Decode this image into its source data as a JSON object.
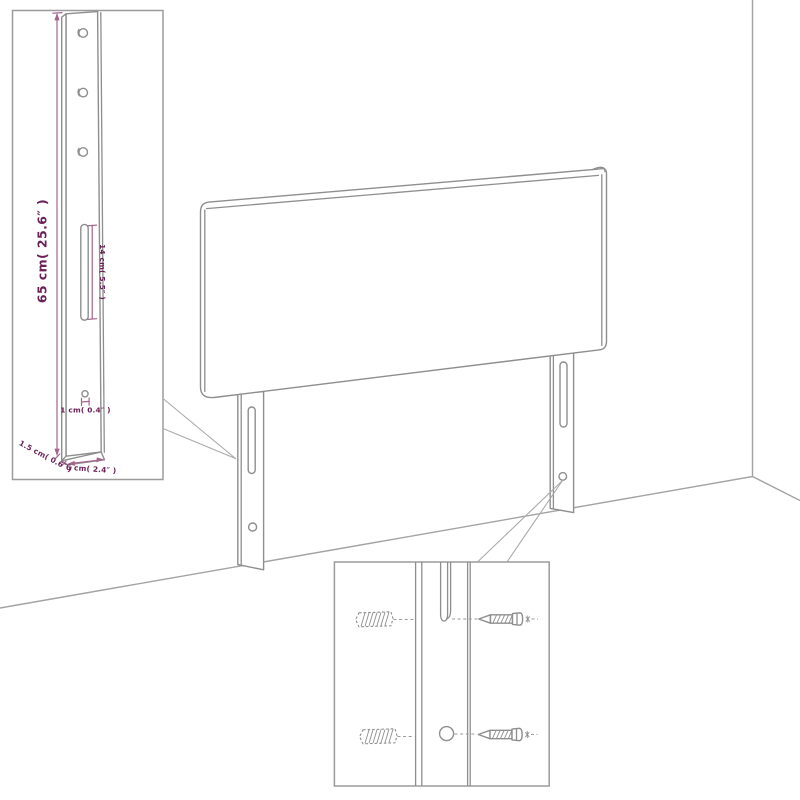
{
  "diagram": {
    "subject": "headboard-assembly-diagram",
    "colors": {
      "background": "#ffffff",
      "outline_gray": "#8e8e8e",
      "wall_gray": "#a3a3a3",
      "inset_border_gray": "#9b9b9b",
      "dimension_line_purple": "#a4648c",
      "dimension_text_purple": "#6b2156"
    },
    "leg_detail_inset": {
      "hole_count": 3,
      "labels": {
        "height": "65 cm( 25.6″ )",
        "slot_length": "14 cm( 5.5″ )",
        "hole_diameter": "1 cm( 0.4″ )",
        "thickness": "1.5 cm( 0.6″ )",
        "width": "6 cm( 2.4″ )"
      }
    },
    "mounting_detail_inset": {
      "wall_plug_count": 2,
      "screw_count": 2
    }
  }
}
